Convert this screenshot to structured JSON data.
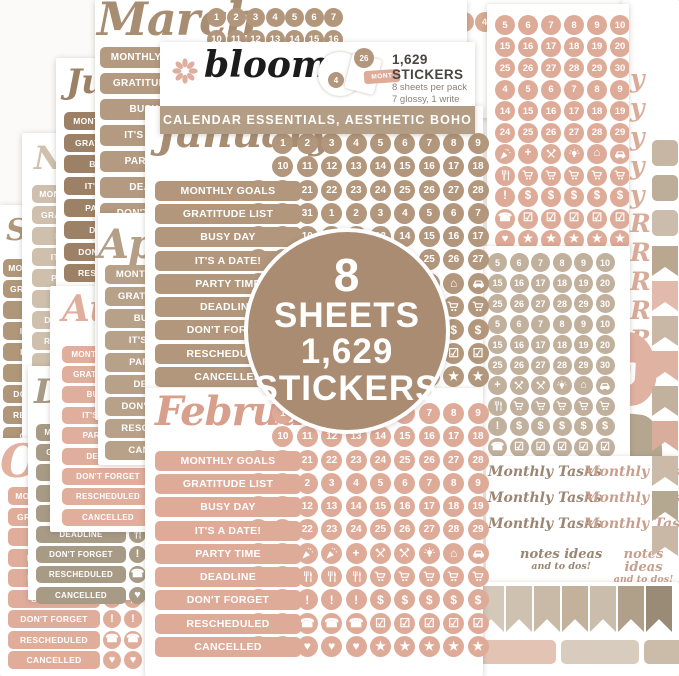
{
  "colors": {
    "tan": "#b2977c",
    "tan_dark": "#9d8166",
    "taupe_script": "#a78e73",
    "pink": "#dfab99",
    "pink_script": "#d8a08c",
    "beige": "#c0b09c",
    "khaki": "#a89b85",
    "cream": "#cfc0ad",
    "badge": "#aa8c72",
    "banner": "#b49d85",
    "logo": "#1c1c1c",
    "flower": "#dfae9f"
  },
  "labels": [
    "MONTHLY GOALS",
    "GRATITUDE LIST",
    "BUSY DAY",
    "IT'S A DATE!",
    "PARTY TIME",
    "DEADLINE",
    "DON'T FORGET",
    "RESCHEDULED",
    "CANCELLED"
  ],
  "header": {
    "brand": "bloom",
    "count": "1,629 STICKERS",
    "per_pack": "8 sheets per pack",
    "finish": "7 glossy, 1 write on",
    "banner": "CALENDAR ESSENTIALS, AESTHETIC BOHO",
    "montage": {
      "circle_large": "26",
      "circle_small": "4",
      "tab": "MONT"
    }
  },
  "badge": {
    "line1": "8",
    "line2": "SHEETS",
    "line3": "1,629",
    "line4": "STICKERS"
  },
  "sheets": {
    "january": {
      "title": "January",
      "rows": [
        [
          "",
          "1",
          "2",
          "3",
          "4",
          "5",
          "6",
          "7",
          "8",
          "9"
        ],
        [
          "",
          "10",
          "11",
          "12",
          "13",
          "14",
          "15",
          "16",
          "17",
          "18"
        ],
        [
          "19",
          "20",
          "21",
          "22",
          "23",
          "24",
          "25",
          "26",
          "27",
          "28"
        ],
        [
          "29",
          "30",
          "31",
          "1",
          "2",
          "3",
          "4",
          "5",
          "6",
          "7"
        ],
        [
          "8",
          "9",
          "10",
          "11",
          "12",
          "13",
          "14",
          "15",
          "16",
          "17"
        ],
        [
          "18",
          "19",
          "20",
          "21",
          "22",
          "23",
          "24",
          "25",
          "26",
          "27"
        ],
        [
          "28",
          "29",
          "30",
          "31",
          "@cake",
          "@party",
          "@plus",
          "@bulb",
          "@home",
          "@car"
        ],
        [
          "@utensils",
          "@utensils",
          "@utensils",
          "@utensils",
          "@utensils",
          "@cart",
          "@cart",
          "@cart",
          "@cart",
          "@cart"
        ],
        [
          "@exclaim",
          "@exclaim",
          "@exclaim",
          "@exclaim",
          "@exclaim",
          "@dollar",
          "@dollar",
          "@dollar",
          "@dollar",
          "@dollar"
        ],
        [
          "@phone",
          "@phone",
          "@phone",
          "@phone",
          "@phone",
          "@calendar",
          "@calendar",
          "@calendar",
          "@calendar",
          "@calendar"
        ],
        [
          "@heart",
          "@heart",
          "@heart",
          "@heart",
          "@heart",
          "@star",
          "@star",
          "@star",
          "@star",
          "@star"
        ]
      ]
    },
    "february": {
      "title": "February",
      "rows": [
        [
          "",
          "1",
          "2",
          "3",
          "4",
          "5",
          "6",
          "7",
          "8",
          "9"
        ],
        [
          "",
          "10",
          "11",
          "12",
          "13",
          "14",
          "15",
          "16",
          "17",
          "18"
        ],
        [
          "19",
          "20",
          "21",
          "22",
          "23",
          "24",
          "25",
          "26",
          "27",
          "28"
        ],
        [
          "29",
          "1",
          "2",
          "3",
          "4",
          "5",
          "6",
          "7",
          "8",
          "9"
        ],
        [
          "10",
          "11",
          "12",
          "13",
          "14",
          "15",
          "16",
          "17",
          "18",
          "19"
        ],
        [
          "20",
          "21",
          "22",
          "23",
          "24",
          "25",
          "26",
          "27",
          "28",
          "29"
        ],
        [
          "@cake",
          "@cake",
          "@party",
          "@party",
          "@plus",
          "@tools",
          "@tools",
          "@bulb",
          "@home",
          "@car"
        ],
        [
          "@utensils",
          "@utensils",
          "@utensils",
          "@utensils",
          "@utensils",
          "@cart",
          "@cart",
          "@cart",
          "@cart",
          "@cart"
        ],
        [
          "@exclaim",
          "@exclaim",
          "@exclaim",
          "@exclaim",
          "@exclaim",
          "@dollar",
          "@dollar",
          "@dollar",
          "@dollar",
          "@dollar"
        ],
        [
          "@phone",
          "@phone",
          "@phone",
          "@phone",
          "@phone",
          "@calendar",
          "@calendar",
          "@calendar",
          "@calendar",
          "@calendar"
        ],
        [
          "@heart",
          "@heart",
          "@heart",
          "@heart",
          "@heart",
          "@star",
          "@star",
          "@star",
          "@star",
          "@star"
        ]
      ]
    },
    "march": {
      "title": "March",
      "rows": [
        [
          "1",
          "2",
          "3",
          "4",
          "5",
          "6",
          "7"
        ],
        [
          "10",
          "11",
          "12",
          "13",
          "14",
          "15",
          "16"
        ]
      ]
    },
    "april": {
      "title": "Apri"
    },
    "may": {
      "title": "May",
      "rows": [
        [
          "1",
          "2",
          "3",
          "4"
        ]
      ]
    },
    "july": {
      "title": "Ju"
    },
    "august": {
      "title": "Au"
    },
    "september": {
      "title": "Se"
    },
    "october": {
      "title": "Oc"
    },
    "november": {
      "title": "No"
    },
    "december": {
      "title": "De"
    },
    "right_pink": {
      "rows": [
        [
          "5",
          "6",
          "7",
          "8",
          "9",
          "10"
        ],
        [
          "15",
          "16",
          "17",
          "18",
          "19",
          "20"
        ],
        [
          "25",
          "26",
          "27",
          "28",
          "29",
          "30"
        ],
        [
          "4",
          "5",
          "6",
          "7",
          "8",
          "9"
        ],
        [
          "14",
          "15",
          "16",
          "17",
          "18",
          "19"
        ],
        [
          "24",
          "25",
          "26",
          "27",
          "28",
          "29"
        ],
        [
          "@party",
          "@plus",
          "@tools",
          "@bulb",
          "@home",
          "@car"
        ],
        [
          "@utensils",
          "@cart",
          "@cart",
          "@cart",
          "@cart",
          "@cart"
        ],
        [
          "@exclaim",
          "@dollar",
          "@dollar",
          "@dollar",
          "@dollar",
          "@dollar"
        ],
        [
          "@phone",
          "@calendar",
          "@calendar",
          "@calendar",
          "@calendar",
          "@calendar"
        ],
        [
          "@heart",
          "@star",
          "@star",
          "@star",
          "@star",
          "@star"
        ]
      ]
    },
    "right_tan": {
      "rows": [
        [
          "5",
          "6",
          "7",
          "8",
          "9",
          "10"
        ],
        [
          "15",
          "16",
          "17",
          "18",
          "19",
          "20"
        ],
        [
          "25",
          "26",
          "27",
          "28",
          "29",
          "30"
        ],
        [
          "5",
          "6",
          "7",
          "8",
          "9",
          "10"
        ],
        [
          "15",
          "16",
          "17",
          "18",
          "19",
          "20"
        ],
        [
          "25",
          "26",
          "27",
          "28",
          "29",
          "30"
        ],
        [
          "@plus",
          "@tools",
          "@tools",
          "@bulb",
          "@home",
          "@car"
        ],
        [
          "@utensils",
          "@cart",
          "@cart",
          "@cart",
          "@cart",
          "@cart"
        ],
        [
          "@exclaim",
          "@dollar",
          "@dollar",
          "@dollar",
          "@dollar",
          "@dollar"
        ],
        [
          "@phone",
          "@calendar",
          "@calendar",
          "@calendar",
          "@calendar",
          "@calendar"
        ],
        [
          "@heart",
          "@star",
          "@star",
          "@star",
          "@star",
          "@star"
        ]
      ]
    },
    "month_edge": {
      "letters": [
        "y",
        "y",
        "y",
        "y",
        "y",
        "R",
        "R",
        "R",
        "R",
        "R",
        "R"
      ]
    },
    "tasks": {
      "item": "Monthly Tasks",
      "notes_line1": "notes ideas",
      "notes_line2": "and to dos!"
    },
    "decor": {
      "fragment1": "g",
      "fragment2": "et"
    }
  },
  "edge": {
    "tabs": [
      "#c6b6a3",
      "#bdae9a",
      "#cbbcab"
    ],
    "pennants": [
      "#b9a78f",
      "#e2baab",
      "#c9b8a5",
      "#dfb3a2",
      "#c2b19d",
      "#d9ad9c",
      "#cbbaa8",
      "#b5a890",
      "#c9b8a6"
    ]
  },
  "flags": {
    "row": [
      "#d5c8b8",
      "#cfc1af",
      "#c9baa7",
      "#c3b19c",
      "#cbbdab",
      "#b1a089",
      "#998b76"
    ],
    "bars": [
      "#e3c4b4",
      "#d8ccbe",
      "#cbbcaa"
    ]
  }
}
